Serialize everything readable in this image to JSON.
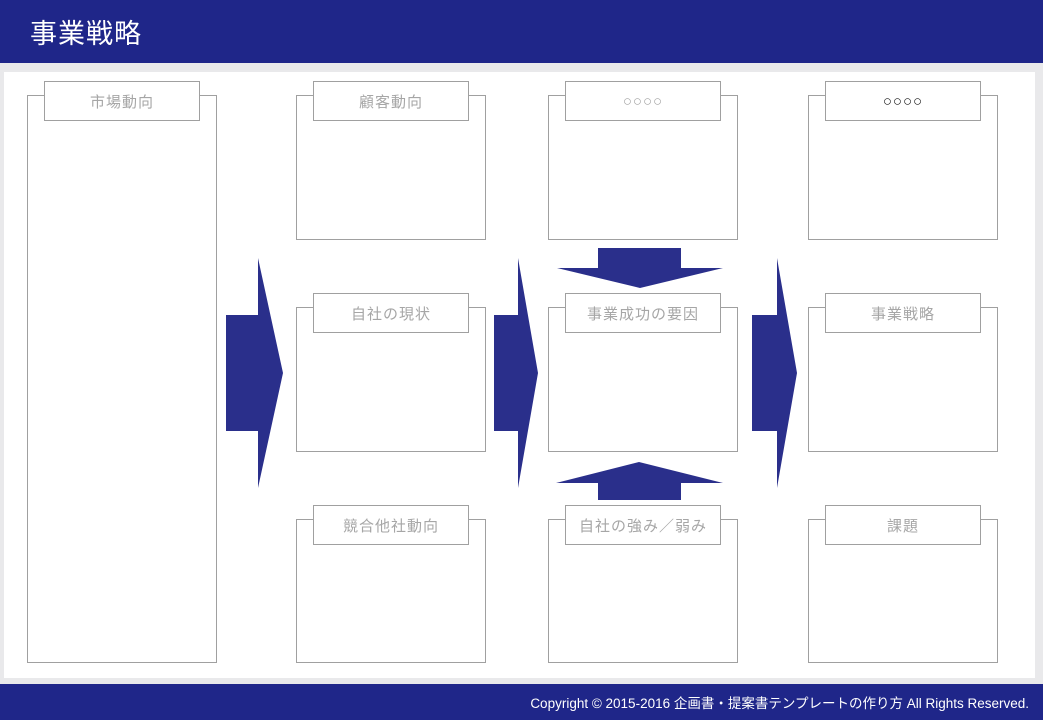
{
  "header": {
    "title": "事業戦略"
  },
  "footer": {
    "copyright": "Copyright © 2015-2016 企画書・提案書テンプレートの作り方 All Rights Reserved."
  },
  "colors": {
    "header_navy": "#1f2689",
    "arrow_navy": "#2a2f8b",
    "box_border": "#a0a0a0",
    "label_gray": "#a6a6a6",
    "placeholder_dark": "#1a1a1a",
    "page_frame_gray": "#e9e9eb"
  },
  "diagram": {
    "cells": [
      {
        "id": "market-trends",
        "label": "市場動向"
      },
      {
        "id": "customer-trends",
        "label": "顧客動向"
      },
      {
        "id": "placeholder-top-gray",
        "label": "○○○○"
      },
      {
        "id": "placeholder-top-dark",
        "label": "○○○○"
      },
      {
        "id": "company-current-state",
        "label": "自社の現状"
      },
      {
        "id": "business-success-factors",
        "label": "事業成功の要因"
      },
      {
        "id": "business-strategy",
        "label": "事業戦略"
      },
      {
        "id": "competitor-trends",
        "label": "競合他社動向"
      },
      {
        "id": "strengths-weaknesses",
        "label": "自社の強み／弱み"
      },
      {
        "id": "issues",
        "label": "課題"
      }
    ],
    "arrows": [
      {
        "id": "arrow-market-to-analysis",
        "direction": "right"
      },
      {
        "id": "arrow-analysis-to-factors",
        "direction": "right"
      },
      {
        "id": "arrow-factors-to-strategy",
        "direction": "right"
      },
      {
        "id": "arrow-customer-to-factors",
        "direction": "down"
      },
      {
        "id": "arrow-strengths-to-factors",
        "direction": "up"
      }
    ]
  }
}
